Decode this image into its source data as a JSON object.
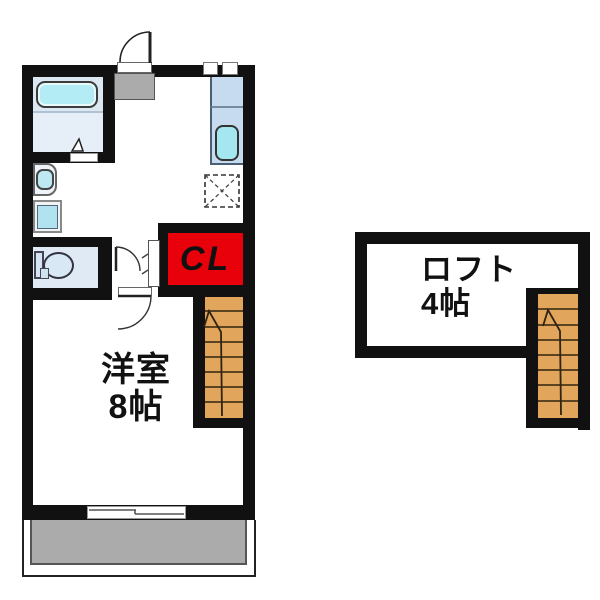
{
  "plan": {
    "labels": {
      "closet": "CL",
      "main_room_name": "洋室",
      "main_room_size": "8帖",
      "loft_name": "ロフト",
      "loft_size": "4帖"
    },
    "colors": {
      "wall": "#111111",
      "closet_red": "#e8000a",
      "stairs_tan": "#e2a55c",
      "balcony_and_entry_gray": "#ababab",
      "bath_floor": "#dbe7f1",
      "bathtub_cyan": "#b3ecf4",
      "kitchen_counter": "#c6dbef",
      "kitchen_sink": "#a5e7f1",
      "washer_pan_blue": "#b0e2f0",
      "toilet_room": "#e0eaf5"
    },
    "fixture_names": [
      "entrance-door",
      "entrance-step",
      "bathtub",
      "bathroom",
      "washbasin",
      "washing-machine-pan",
      "toilet",
      "kitchen-counter",
      "kitchen-sink",
      "refrigerator-space",
      "closet",
      "staircase-first-floor",
      "staircase-loft",
      "sliding-window",
      "balcony"
    ]
  }
}
